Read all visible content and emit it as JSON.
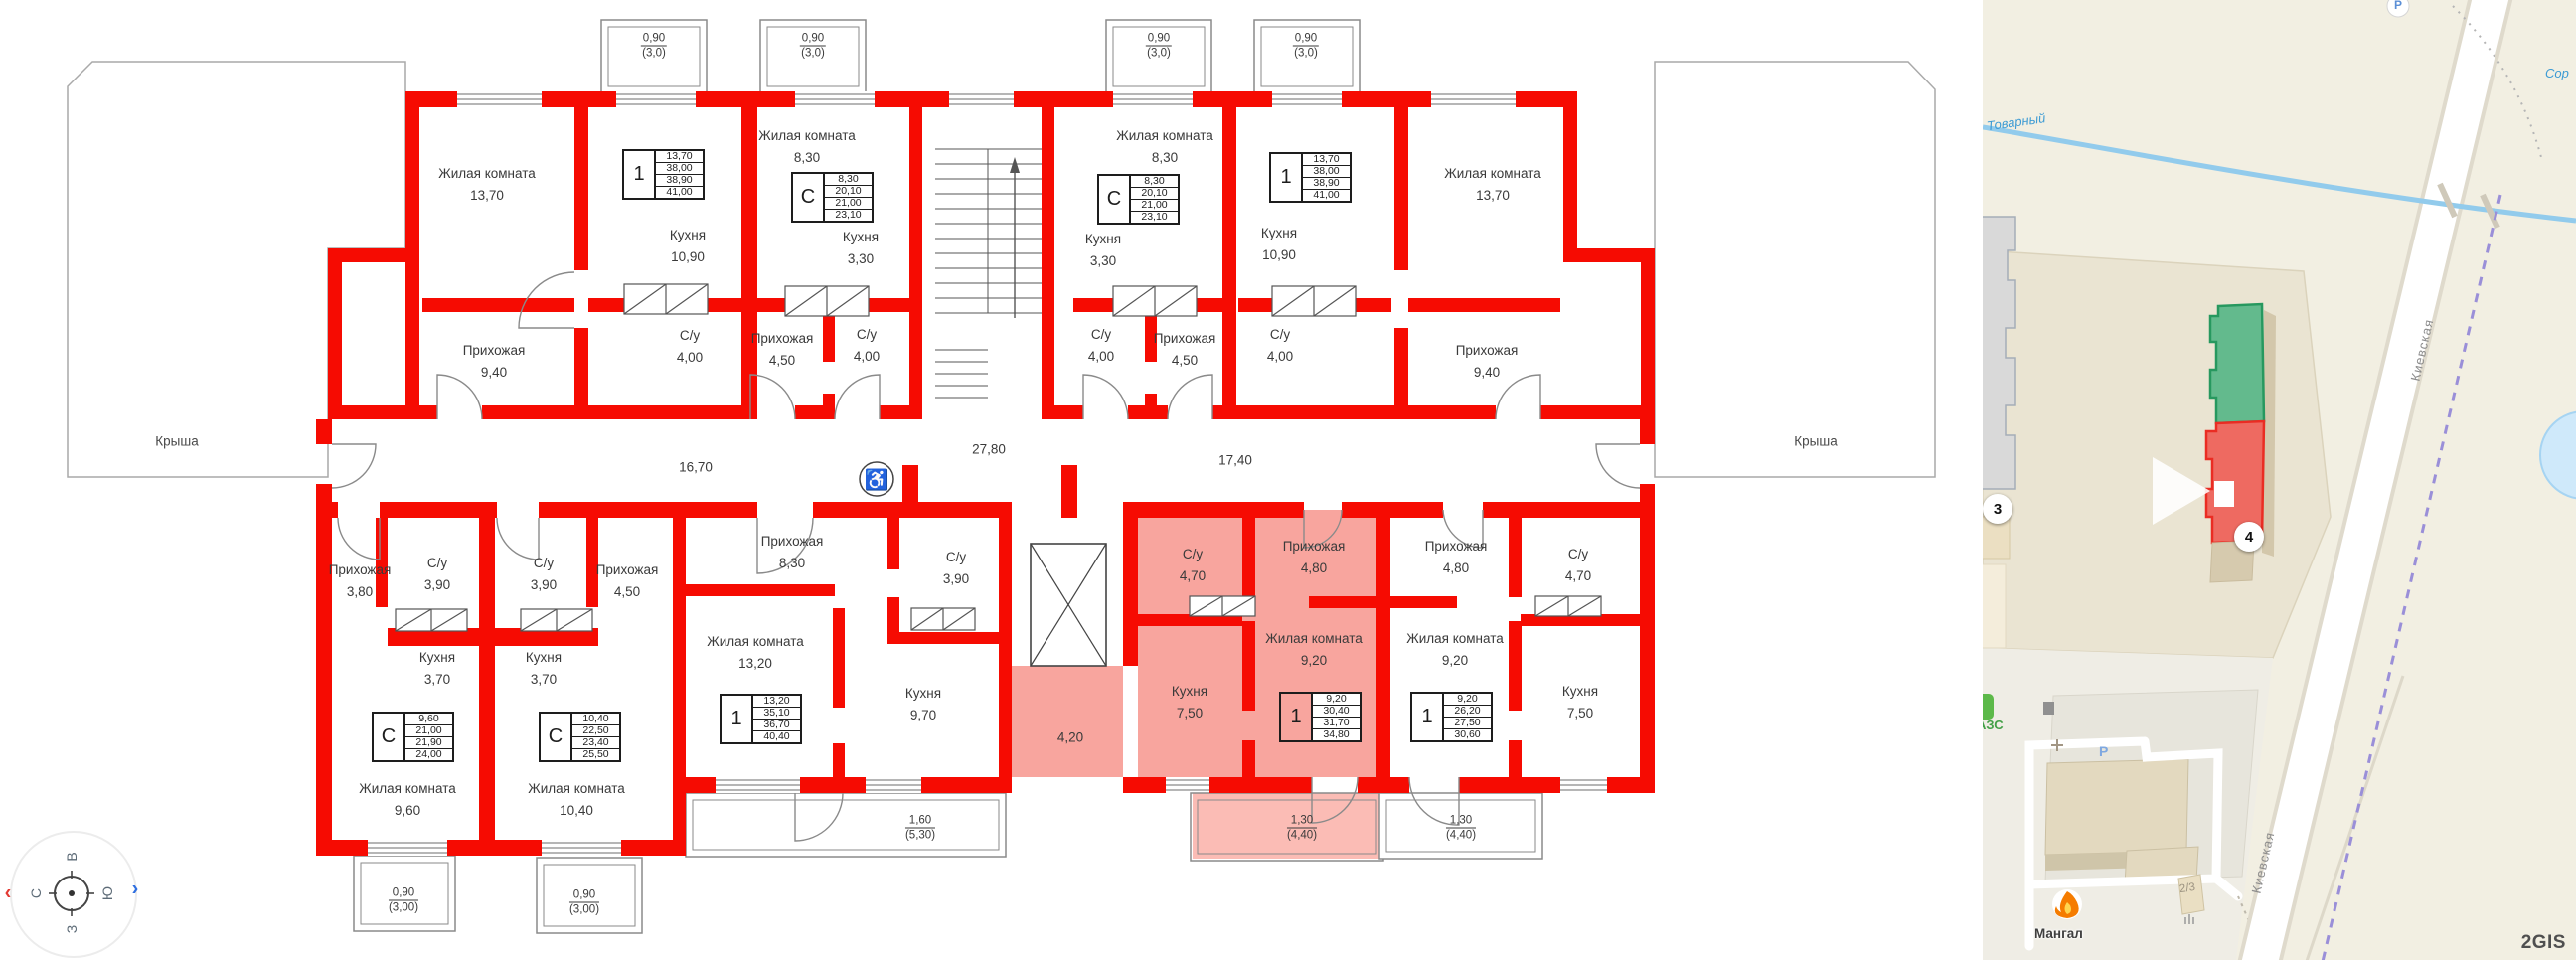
{
  "plan": {
    "roof_left": "Крыша",
    "roof_right": "Крыша",
    "wheelchair_icon": "♿",
    "rooms": [
      {
        "name": "Жилая комната",
        "area": "13,70"
      },
      {
        "name": "Кухня",
        "area": "10,90"
      },
      {
        "name": "С/у",
        "area": "4,00"
      },
      {
        "name": "Прихожая",
        "area": "9,40"
      },
      {
        "name": "Жилая комната",
        "area": "8,30"
      },
      {
        "name": "Кухня",
        "area": "3,30"
      },
      {
        "name": "Прихожая",
        "area": "4,50"
      },
      {
        "name": "С/у",
        "area": "4,00"
      },
      {
        "name": "Жилая комната",
        "area": "8,30"
      },
      {
        "name": "Кухня",
        "area": "3,30"
      },
      {
        "name": "С/у",
        "area": "4,00"
      },
      {
        "name": "Прихожая",
        "area": "4,50"
      },
      {
        "name": "Кухня",
        "area": "10,90"
      },
      {
        "name": "С/у",
        "area": "4,00"
      },
      {
        "name": "Прихожая",
        "area": "9,40"
      },
      {
        "name": "Жилая комната",
        "area": "13,70"
      },
      {
        "name": "Прихожая",
        "area": "3,80"
      },
      {
        "name": "С/у",
        "area": "3,90"
      },
      {
        "name": "С/у",
        "area": "3,90"
      },
      {
        "name": "Прихожая",
        "area": "4,50"
      },
      {
        "name": "Кухня",
        "area": "3,70"
      },
      {
        "name": "Кухня",
        "area": "3,70"
      },
      {
        "name": "Жилая комната",
        "area": "9,60"
      },
      {
        "name": "Жилая комната",
        "area": "10,40"
      },
      {
        "name": "Прихожая",
        "area": "8,30"
      },
      {
        "name": "Жилая комната",
        "area": "13,20"
      },
      {
        "name": "С/у",
        "area": "3,90"
      },
      {
        "name": "Кухня",
        "area": "9,70"
      },
      {
        "name": "С/у",
        "area": "4,70"
      },
      {
        "name": "Прихожая",
        "area": "4,80"
      },
      {
        "name": "Жилая комната",
        "area": "9,20"
      },
      {
        "name": "Кухня",
        "area": "7,50"
      },
      {
        "name": "Прихожая",
        "area": "4,80"
      },
      {
        "name": "С/у",
        "area": "4,70"
      },
      {
        "name": "Жилая комната",
        "area": "9,20"
      },
      {
        "name": "Кухня",
        "area": "7,50"
      }
    ],
    "corridors": [
      {
        "value": "16,70"
      },
      {
        "value": "27,80"
      },
      {
        "value": "17,40"
      },
      {
        "value": "4,20"
      }
    ],
    "balconies": [
      {
        "value": "0,90",
        "sub": "(3,0)"
      },
      {
        "value": "0,90",
        "sub": "(3,0)"
      },
      {
        "value": "0,90",
        "sub": "(3,0)"
      },
      {
        "value": "0,90",
        "sub": "(3,0)"
      },
      {
        "value": "0,90",
        "sub": "(3,00)"
      },
      {
        "value": "0,90",
        "sub": "(3,00)"
      },
      {
        "value": "1,60",
        "sub": "(5,30)"
      },
      {
        "value": "1,30",
        "sub": "(4,40)"
      },
      {
        "value": "1,30",
        "sub": "(4,40)"
      }
    ],
    "tables": [
      {
        "type": "1",
        "rows": [
          "13,70",
          "38,00",
          "38,90",
          "41,00"
        ]
      },
      {
        "type": "С",
        "rows": [
          "8,30",
          "20,10",
          "21,00",
          "23,10"
        ]
      },
      {
        "type": "С",
        "rows": [
          "8,30",
          "20,10",
          "21,00",
          "23,10"
        ]
      },
      {
        "type": "1",
        "rows": [
          "13,70",
          "38,00",
          "38,90",
          "41,00"
        ]
      },
      {
        "type": "С",
        "rows": [
          "9,60",
          "21,00",
          "21,90",
          "24,00"
        ]
      },
      {
        "type": "С",
        "rows": [
          "10,40",
          "22,50",
          "23,40",
          "25,50"
        ]
      },
      {
        "type": "1",
        "rows": [
          "13,20",
          "35,10",
          "36,70",
          "40,40"
        ]
      },
      {
        "type": "1",
        "rows": [
          "9,20",
          "30,40",
          "31,70",
          "34,80"
        ]
      },
      {
        "type": "1",
        "rows": [
          "9,20",
          "26,20",
          "27,50",
          "30,60"
        ]
      }
    ]
  },
  "compass": {
    "top": "В",
    "left": "С",
    "right": "Ю",
    "bottom": "З"
  },
  "map": {
    "stream": "Ручей Товарный",
    "street": "Киевская",
    "street_lower": "Киевская",
    "clipped_label": "Сор",
    "parking_top": "P",
    "parking": "P",
    "gas_station": "АЗС",
    "bbq": "Мангал",
    "house_number": "2/3",
    "marker_3": "3",
    "marker_4": "4",
    "logo": "2GIS"
  }
}
